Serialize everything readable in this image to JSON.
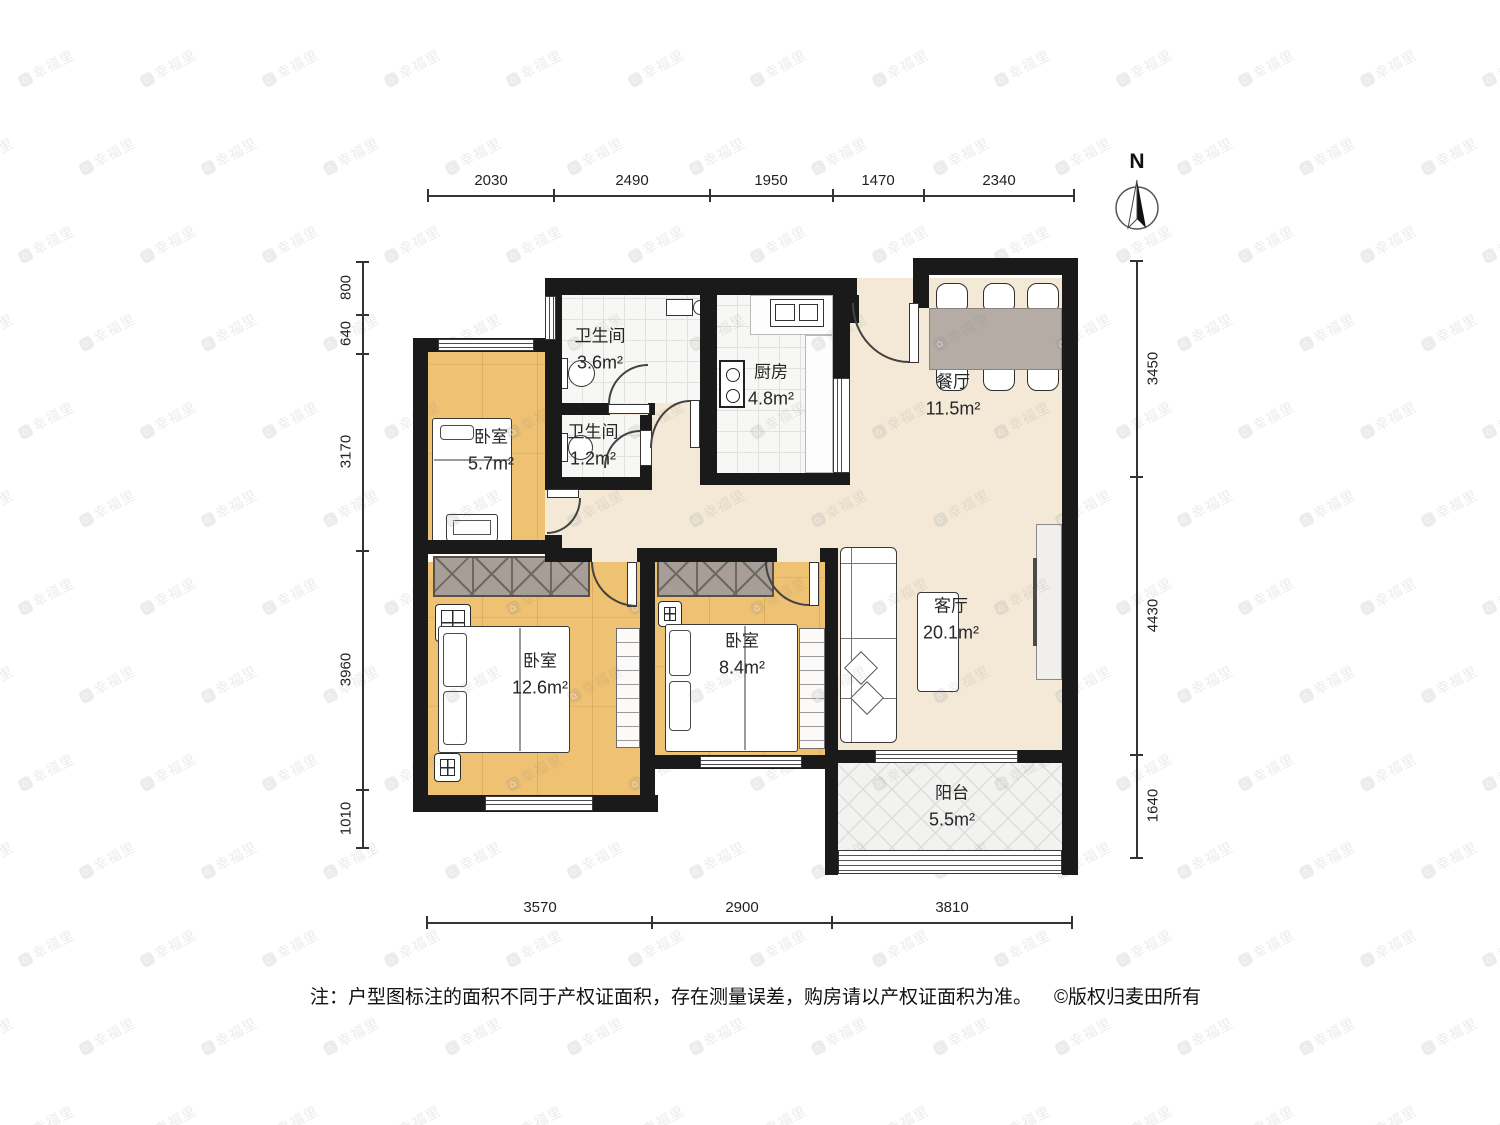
{
  "compass": {
    "label": "N"
  },
  "watermark": {
    "text": "幸福里"
  },
  "rooms": {
    "bath_main": {
      "name": "卫生间",
      "area": "3.6m²"
    },
    "bath_small": {
      "name": "卫生间",
      "area": "1.2m²"
    },
    "kitchen": {
      "name": "厨房",
      "area": "4.8m²"
    },
    "dining": {
      "name": "餐厅",
      "area": "11.5m²"
    },
    "bedroom_north": {
      "name": "卧室",
      "area": "5.7m²"
    },
    "bedroom_master": {
      "name": "卧室",
      "area": "12.6m²"
    },
    "bedroom_second": {
      "name": "卧室",
      "area": "8.4m²"
    },
    "living": {
      "name": "客厅",
      "area": "20.1m²"
    },
    "balcony": {
      "name": "阳台",
      "area": "5.5m²"
    }
  },
  "dimensions": {
    "top": [
      "2030",
      "2490",
      "1950",
      "1470",
      "2340"
    ],
    "left": [
      "800",
      "640",
      "3170",
      "3960",
      "1010"
    ],
    "right": [
      "3450",
      "4430",
      "1640"
    ],
    "bottom": [
      "3570",
      "2900",
      "3810"
    ]
  },
  "note": {
    "text": "注：户型图标注的面积不同于产权证面积，存在测量误差，购房请以产权证面积为准。",
    "copyright": "©版权归麦田所有"
  }
}
